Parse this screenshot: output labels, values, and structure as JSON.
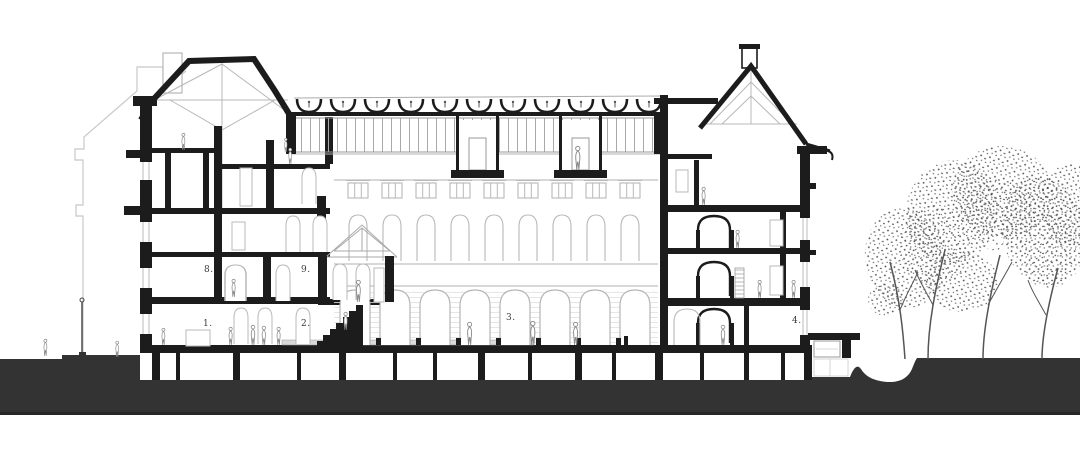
{
  "drawing": {
    "kind": "architectural-cross-section",
    "room_labels": [
      {
        "id": "1",
        "text": "1."
      },
      {
        "id": "2",
        "text": "2."
      },
      {
        "id": "3",
        "text": "3."
      },
      {
        "id": "4",
        "text": "4."
      },
      {
        "id": "8",
        "text": "8."
      },
      {
        "id": "9",
        "text": "9."
      }
    ],
    "colors": {
      "background": "#ffffff",
      "cut_lines": "#1c1c1c",
      "ground_poche": "#333333",
      "elevation_lines": "#b8b8b8",
      "figure_lines": "#8a8a8a"
    }
  }
}
